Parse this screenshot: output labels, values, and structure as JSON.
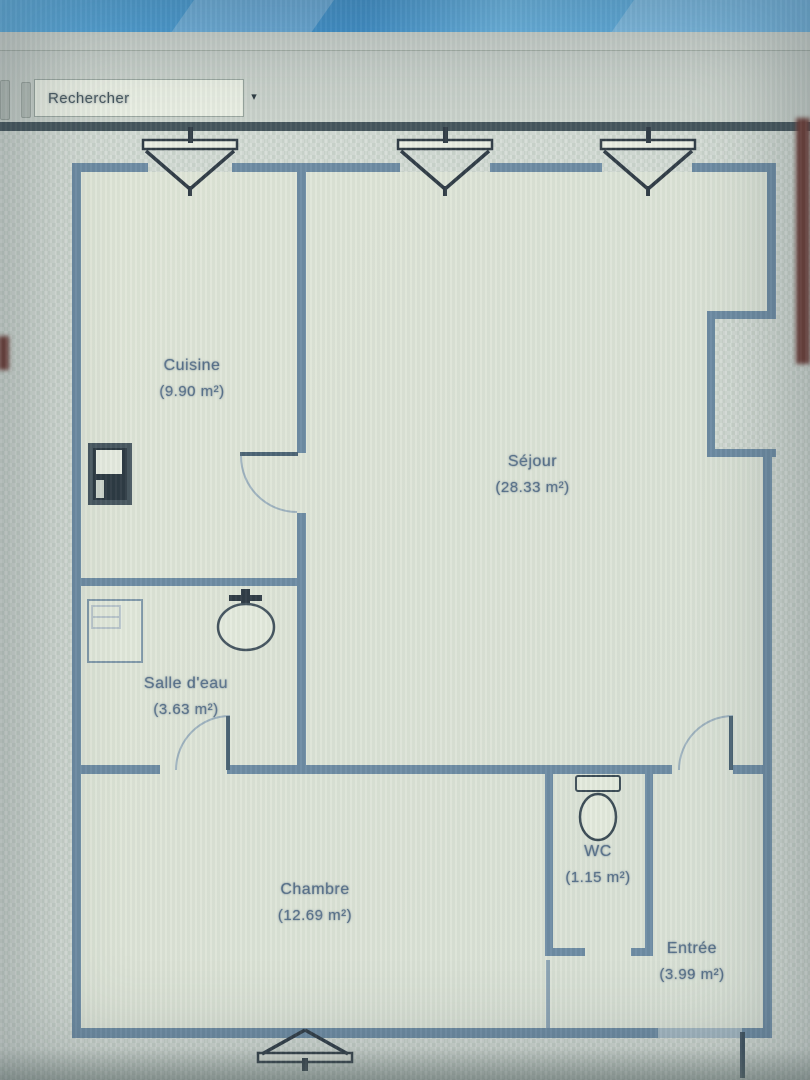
{
  "toolbar": {
    "search_value": "Rechercher",
    "dropdown_arrow": "▾"
  },
  "rooms": [
    {
      "name": "Cuisine",
      "area": "(9.90 m²)"
    },
    {
      "name": "Séjour",
      "area": "(28.33 m²)"
    },
    {
      "name": "Salle d'eau",
      "area": "(3.63 m²)"
    },
    {
      "name": "Chambre",
      "area": "(12.69 m²)"
    },
    {
      "name": "WC",
      "area": "(1.15 m²)"
    },
    {
      "name": "Entrée",
      "area": "(3.99 m²)"
    }
  ],
  "colors": {
    "wall": "#6d8ba3",
    "fixture_dark": "#3a4a54",
    "label_text": "#57708a",
    "interior": "#dfe5d8",
    "workspace": "#ccd5cd",
    "toolbar_bg": "#c9d1ca",
    "title_blue": "#4aa0d8",
    "artifact_red": "#6f3c35"
  }
}
